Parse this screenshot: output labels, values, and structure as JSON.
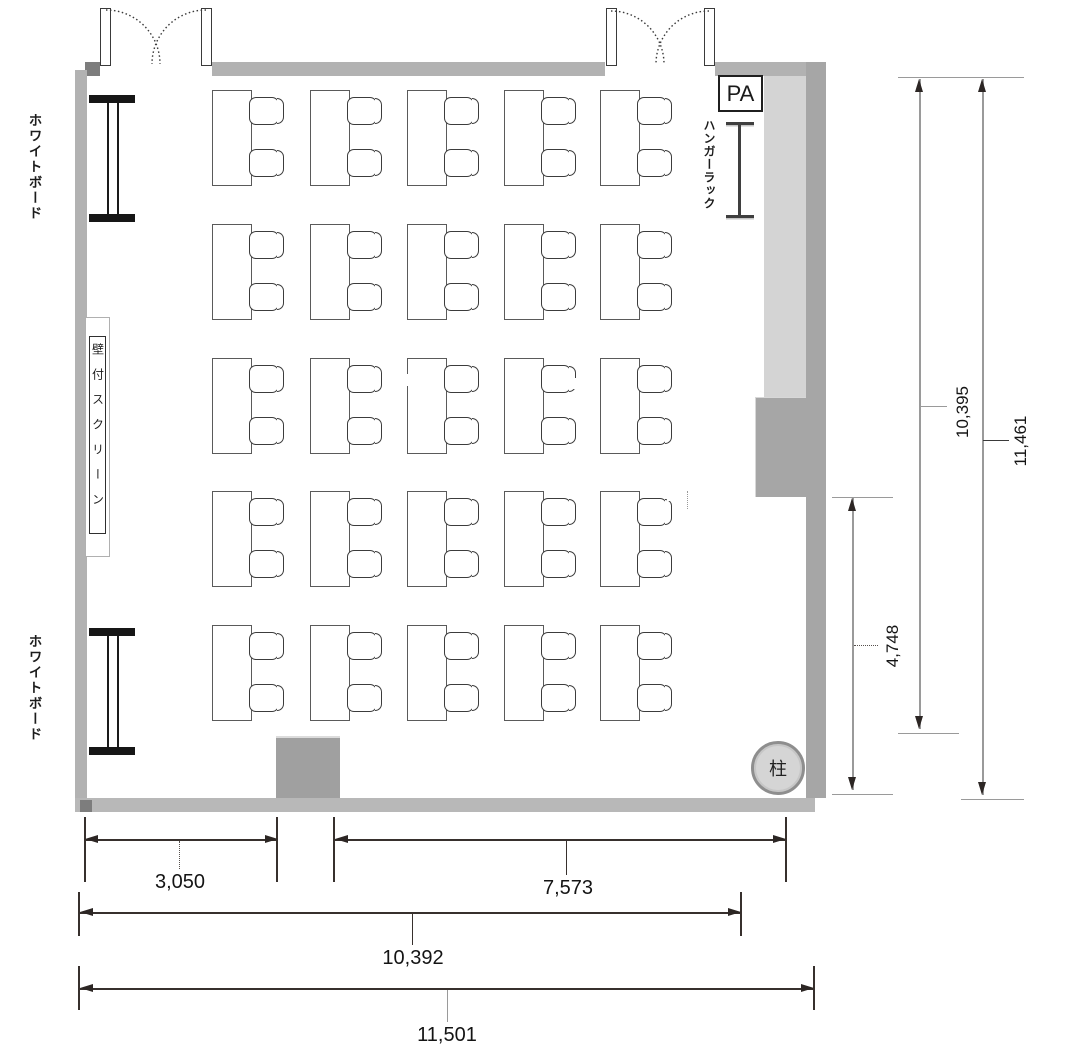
{
  "floor_plan": {
    "equipment": {
      "whiteboard_top_label": "ホワイトボード",
      "whiteboard_bottom_label": "ホワイトボード",
      "wall_screen_label": "壁付スクリーン",
      "hanger_rack_label": "ハンガーラック",
      "pa_label": "PA",
      "pillar_label": "柱"
    },
    "dimensions_mm": {
      "bottom_segment_left": "3,050",
      "bottom_segment_right": "7,573",
      "bottom_inner_width": "10,392",
      "bottom_overall_width": "11,501",
      "right_inner_height": "10,395",
      "right_overall_height": "11,461",
      "right_partial_height": "4,748"
    },
    "furniture": {
      "table_columns": 5,
      "table_rows": 5,
      "tables_total": 25,
      "chairs_per_table": 2,
      "chairs_total": 50
    },
    "colors": {
      "wall": "#b2b2b2",
      "wall_dark": "#a6a6a6",
      "hanger_area": "#d4d4d4",
      "pillar_fill": "#d5d5d5",
      "dimension_line": "#37302d",
      "dimension_stem_gray": "#9a9a9a"
    }
  }
}
